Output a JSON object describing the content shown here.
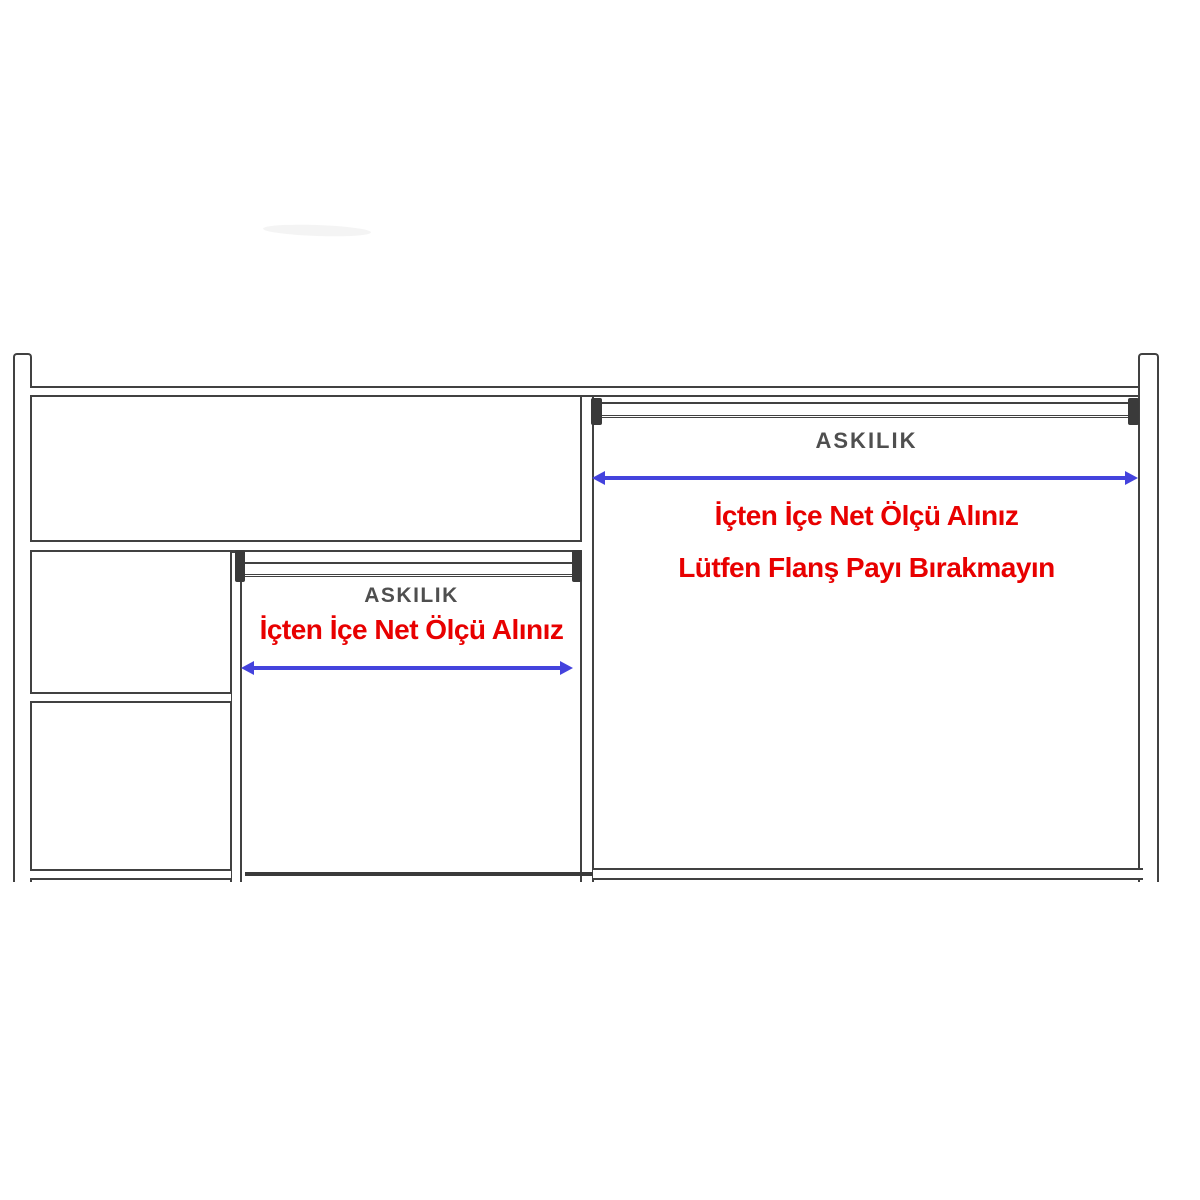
{
  "diagram": {
    "type": "wardrobe-interior-technical-drawing",
    "colors": {
      "line": "#414141",
      "rail_label_text": "#4f4f4f",
      "warning_text": "#e80000",
      "measure_arrow": "#4443dd",
      "background": "#ffffff"
    },
    "middle_compartment": {
      "rail_label": "ASKILIK",
      "note_line1": "İçten İçe Net Ölçü Alınız"
    },
    "right_compartment": {
      "rail_label": "ASKILIK",
      "note_line1": "İçten İçe Net Ölçü Alınız",
      "note_line2": "Lütfen Flanş Payı Bırakmayın"
    }
  }
}
